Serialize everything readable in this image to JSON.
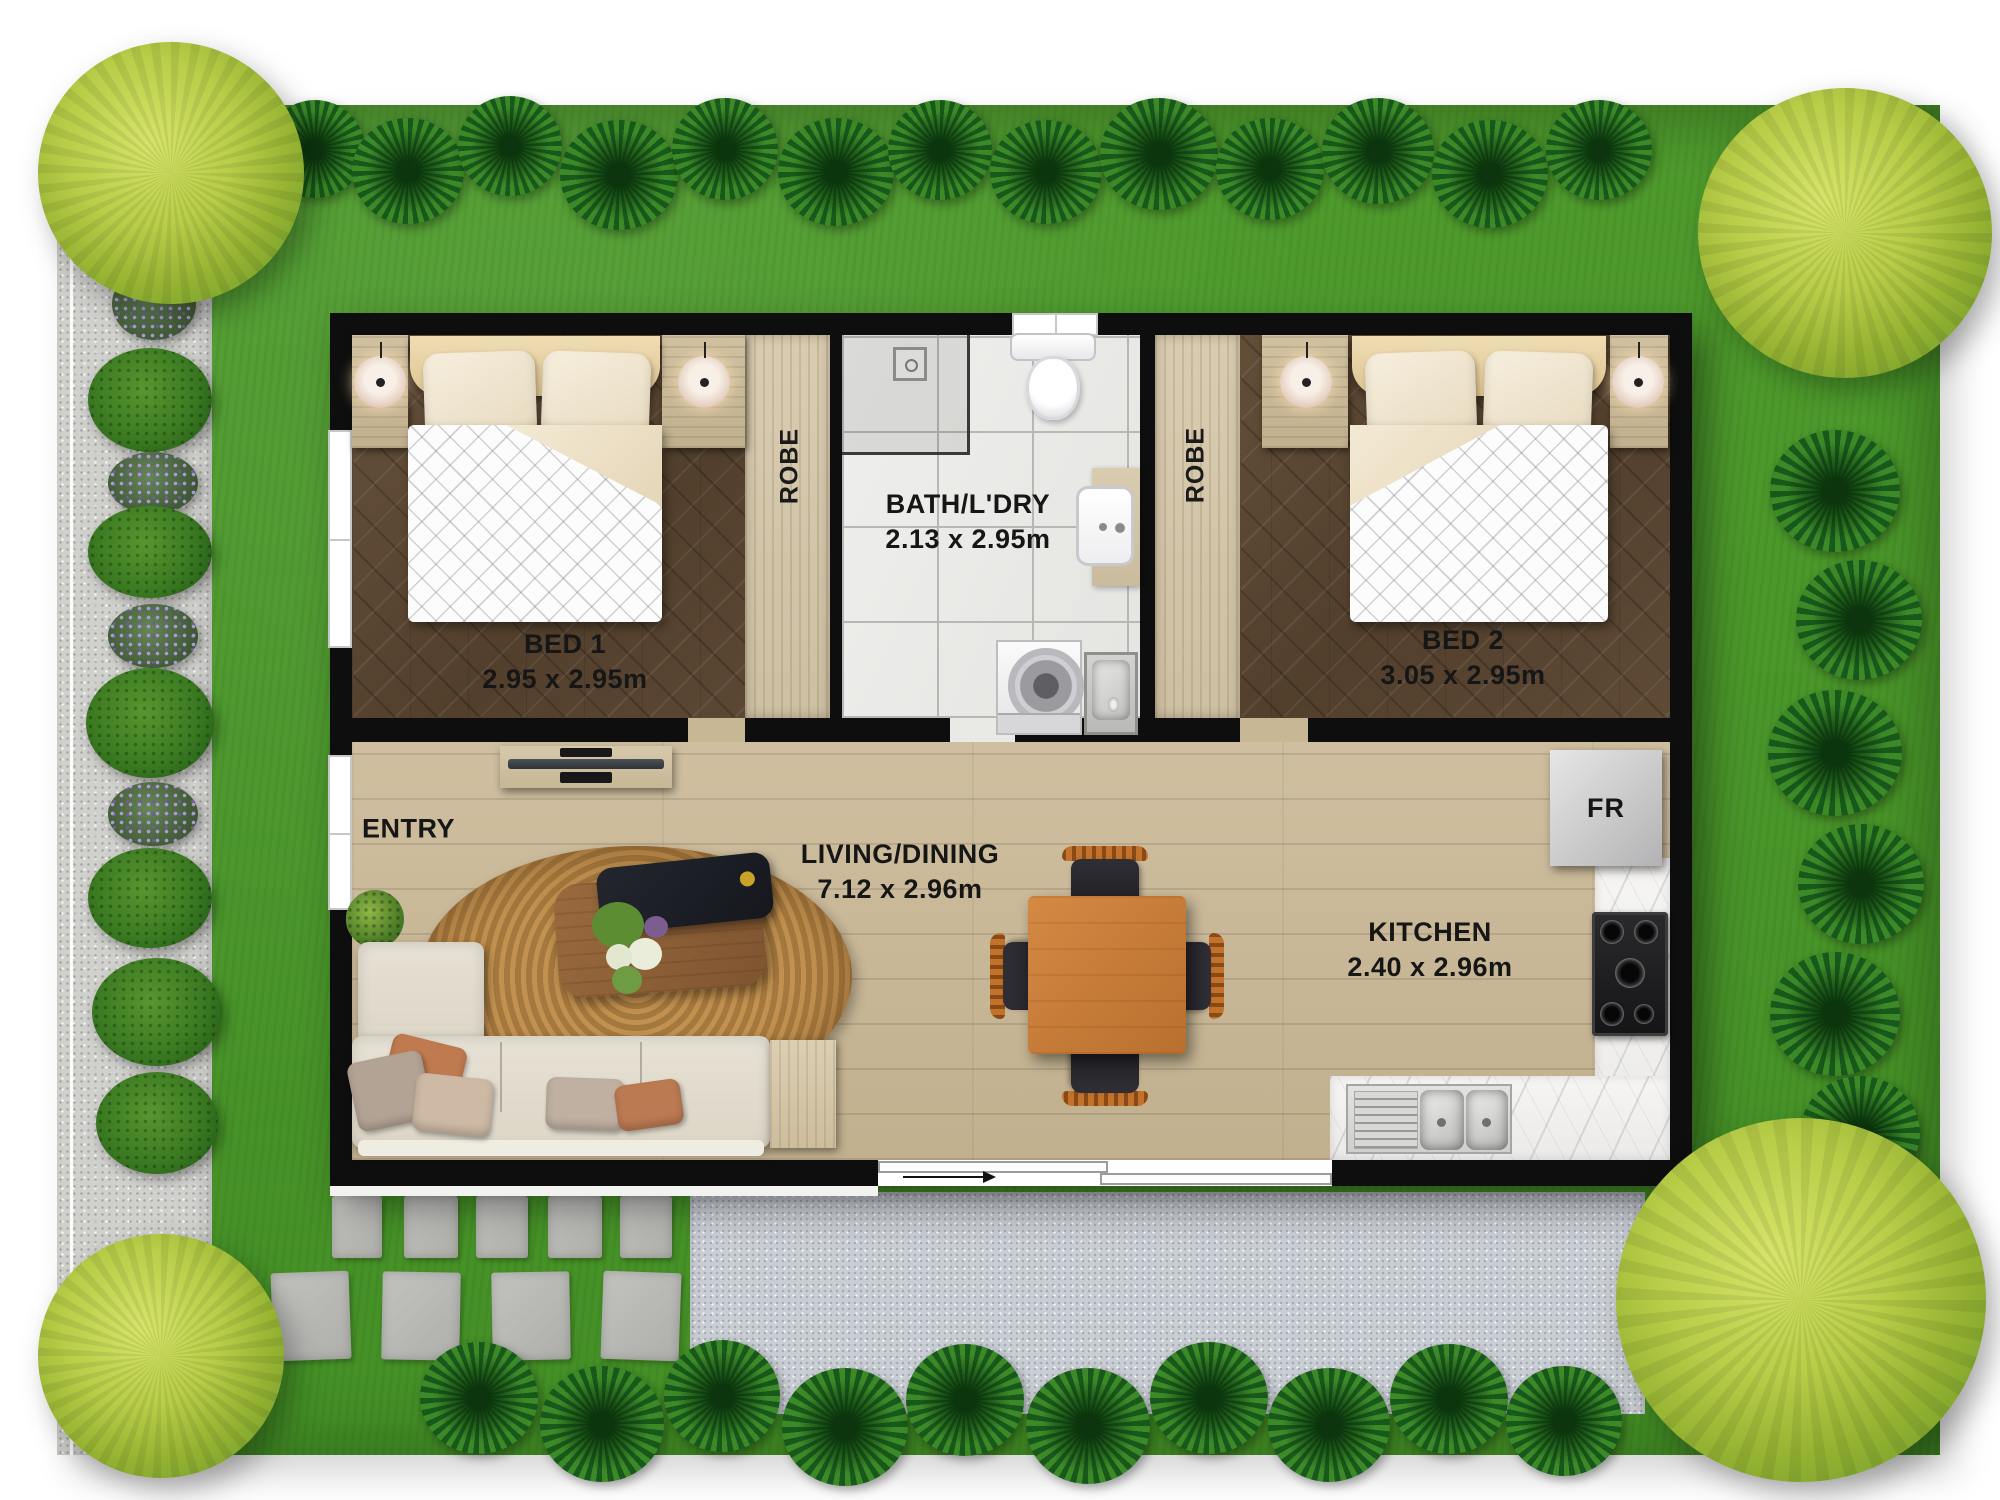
{
  "rooms": {
    "bed1": {
      "name": "BED 1",
      "dims": "2.95 x 2.95m"
    },
    "bed2": {
      "name": "BED 2",
      "dims": "3.05 x 2.95m"
    },
    "bath": {
      "name": "BATH/L'DRY",
      "dims": "2.13 x 2.95m"
    },
    "living": {
      "name": "LIVING/DINING",
      "dims": "7.12 x 2.96m"
    },
    "kitchen": {
      "name": "KITCHEN",
      "dims": "2.40 x 2.96m"
    },
    "entry": {
      "name": "ENTRY"
    },
    "robe1": {
      "name": "ROBE"
    },
    "robe2": {
      "name": "ROBE"
    },
    "fridge": {
      "name": "FR"
    }
  },
  "colors": {
    "grass": "#4b9729",
    "gravel": "#d0d0cd",
    "patio": "#c9ced4",
    "wall": "#0e0e0e",
    "bedroom_floor": "#5c4833",
    "living_floor": "#c8b795",
    "tile_floor": "#ebebe9",
    "robe_wood": "#d4c7ab",
    "marble_counter": "#f4f3f1",
    "rug": "#b8854e",
    "dining_table": "#c8803d",
    "sofa": "#e0dbce",
    "tree_canopy": "#a9c43d",
    "label_text": "#161616"
  },
  "icons": {
    "tree-icon": "round canopy blob",
    "spiky-plant-icon": "radial spike tuft",
    "bush-icon": "round shrub",
    "lavender-bush-icon": "purple flowering shrub",
    "double-bed-icon": "bed with pillows and duvet",
    "lamp-icon": "glowing bedside lamp",
    "shower-icon": "tiled corner with rose",
    "toilet-icon": "tank and bowl",
    "basin-icon": "vanity basin",
    "washing-machine-icon": "top loader drum",
    "laundry-tub-icon": "stainless tub",
    "tv-unit-icon": "media cabinet with tv",
    "sofa-icon": "l-shaped sofa",
    "rug-icon": "oval jute rug",
    "coffee-table-icon": "wood table with tray",
    "dining-table-icon": "square table four chairs",
    "fridge-icon": "refrigerator",
    "cooktop-icon": "5 burner gas hob",
    "sink-icon": "double bowl sink with drainer",
    "entry-arrow-icon": "sliding door direction arrow",
    "paver-icon": "concrete stepping stone"
  }
}
